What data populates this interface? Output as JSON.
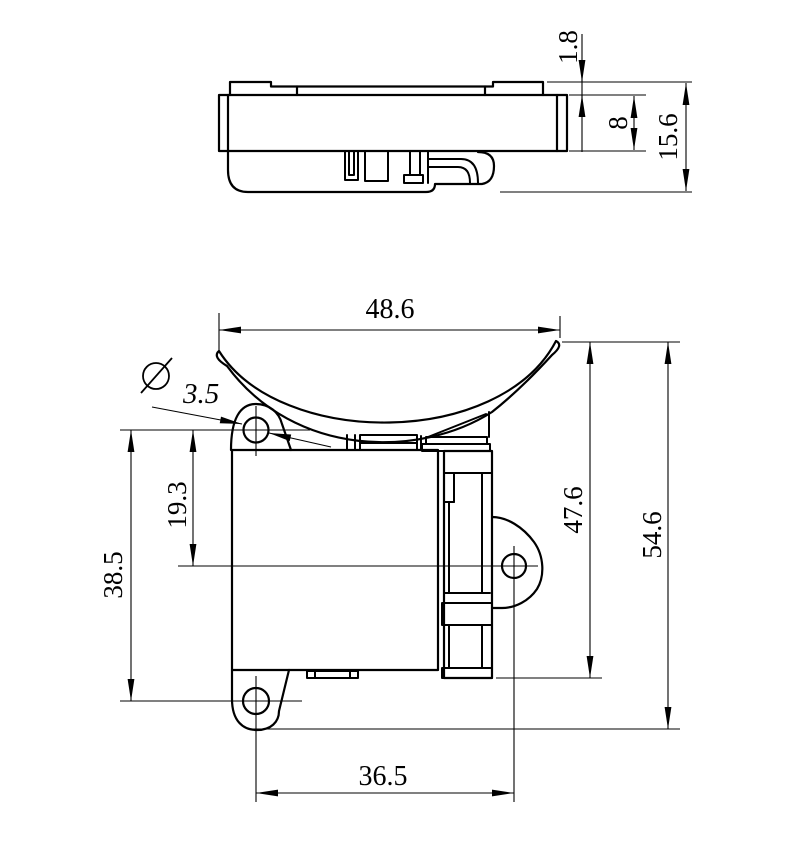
{
  "drawing": {
    "kind": "two-view engineering drawing of a clamp / saddle bracket",
    "line_color": "#000000",
    "background_color": "#ffffff"
  },
  "dimensions": {
    "top_view": {
      "flange_thickness": "1.8",
      "body_height": "8",
      "overall_height": "15.6"
    },
    "front_view": {
      "saddle_width": "48.6",
      "diameter_symbol": "∅",
      "hole_diameter": "3.5",
      "upper_to_middle_hole_spacing": "19.3",
      "upper_to_lower_hole_spacing": "38.5",
      "saddle_to_foot_height": "47.6",
      "overall_height": "54.6",
      "lower_holes_horizontal_spacing": "36.5"
    }
  }
}
